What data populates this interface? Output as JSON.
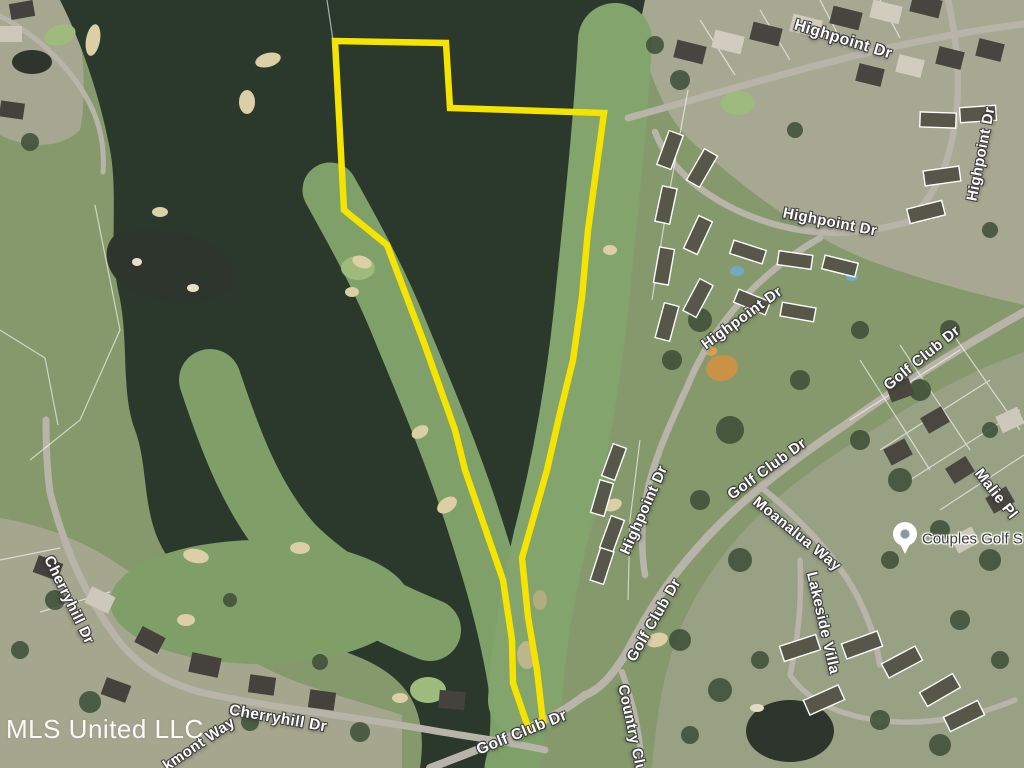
{
  "map": {
    "description": "Aerial satellite listing photo of a wooded parcel outlined in yellow beside a golf course and residential streets",
    "watermark": "MLS United LLC",
    "colors": {
      "boundary": "#F5E300",
      "forest": "#2A392B",
      "fairway": "#7DA164",
      "green": "#9CBC79",
      "residential": "#A6A78F",
      "road": "#B8B4A8",
      "sand": "#DDCFA2",
      "water": "#2E352B",
      "pool": "#6FA9C9",
      "dirt": "#CF9140",
      "label": "#FFFFFF",
      "poi": "#3B3B3B"
    },
    "property_outline": {
      "points": "335,41 446,43 450,108 604,113 588,230 582,297 573,360 560,413 547,470 522,558 528,617 537,670 543,722 529,730 513,683 512,640 503,580 465,470 455,430 423,340 387,245 344,210"
    },
    "street_labels": [
      {
        "id": "highpoint-dr-top",
        "text": "Highpoint Dr"
      },
      {
        "id": "highpoint-dr-right",
        "text": "Highpoint Dr"
      },
      {
        "id": "highpoint-dr-mid",
        "text": "Highpoint Dr"
      },
      {
        "id": "highpoint-dr-diagonal",
        "text": "Highpoint Dr"
      },
      {
        "id": "highpoint-dr-vertical",
        "text": "Highpoint Dr"
      },
      {
        "id": "golf-club-dr-upper",
        "text": "Golf Club Dr"
      },
      {
        "id": "golf-club-dr-mid",
        "text": "Golf Club Dr"
      },
      {
        "id": "golf-club-dr-lower",
        "text": "Golf Club Dr"
      },
      {
        "id": "golf-club-dr-bottom",
        "text": "Golf Club Dr"
      },
      {
        "id": "moanalua-way",
        "text": "Moanalua Way"
      },
      {
        "id": "malie-pl",
        "text": "Malie Pl"
      },
      {
        "id": "lakeside-villa",
        "text": "Lakeside Villa"
      },
      {
        "id": "country-club",
        "text": "Country Clu"
      },
      {
        "id": "cherryhill-dr-left",
        "text": "Cherryhill Dr"
      },
      {
        "id": "cherryhill-dr-bottom",
        "text": "Cherryhill Dr"
      },
      {
        "id": "kmont-way",
        "text": "kmont Way"
      }
    ],
    "poi": {
      "label": "Couples Golf S",
      "icon": "location-pin-icon"
    }
  }
}
